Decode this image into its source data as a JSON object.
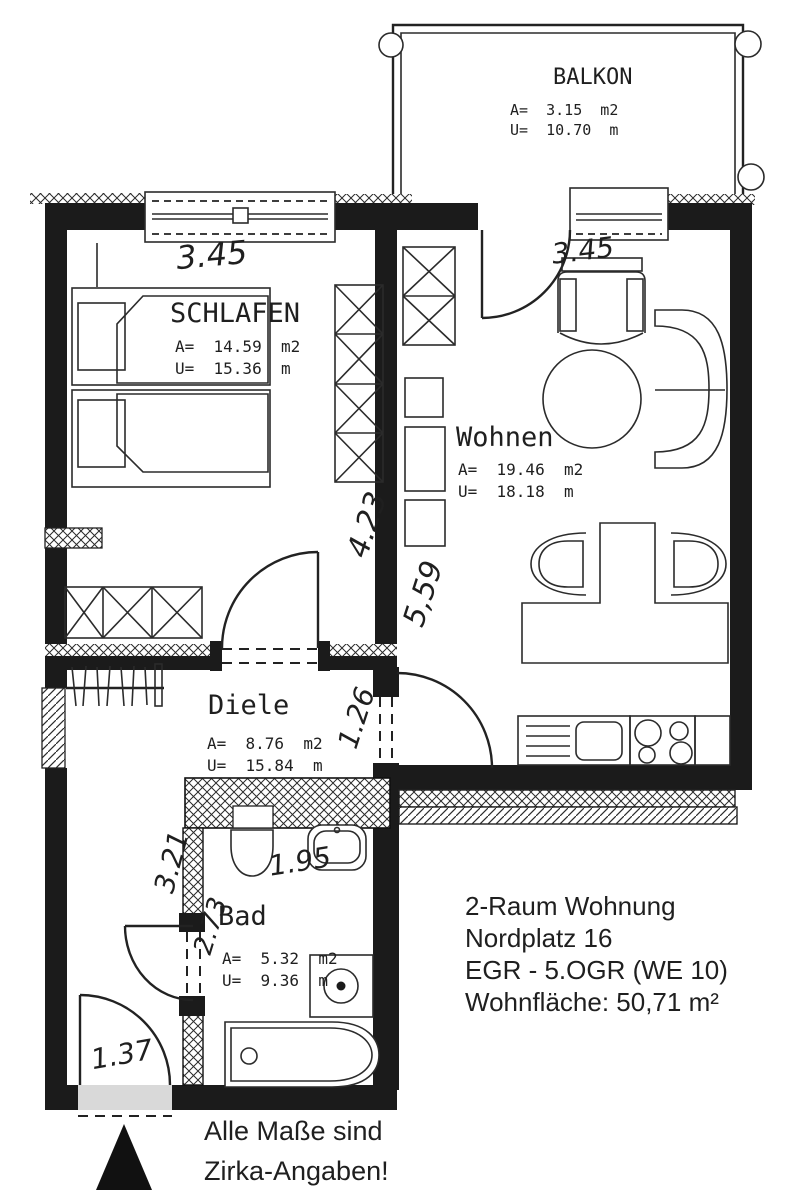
{
  "document": {
    "type": "apartment-floor-plan"
  },
  "balcony": {
    "name": "BALKON",
    "area": "A=  3.15  m2",
    "perimeter": "U=  10.70  m"
  },
  "rooms": {
    "schlafen": {
      "name": "SCHLAFEN",
      "area": "A=  14.59  m2",
      "perimeter": "U=  15.36  m"
    },
    "wohnen": {
      "name": "Wohnen",
      "area": "A=  19.46  m2",
      "perimeter": "U=  18.18  m"
    },
    "diele": {
      "name": "Diele",
      "area": "A=  8.76  m2",
      "perimeter": "U=  15.84  m"
    },
    "bad": {
      "name": "Bad",
      "area": "A=  5.32  m2",
      "perimeter": "U=  9.36  m"
    }
  },
  "dimensions": {
    "schlafen_width": "3.45",
    "wohnen_width": "3.45",
    "schlafen_depth": "4.23",
    "wohnen_depth": "5,59",
    "diele_opening": "1.26",
    "hall_left": "3.21",
    "bad_door": "2.73",
    "bad_width": "1.95",
    "entry_door": "1.37"
  },
  "info_block": {
    "line1": "2-Raum Wohnung",
    "line2": "Nordplatz 16",
    "line3": "EGR - 5.OGR (WE 10)",
    "line4": "Wohnfläche: 50,71 m²"
  },
  "disclaimer": {
    "line1": "Alle Maße sind",
    "line2": "Zirka-Angaben!"
  },
  "symbols": [
    "double-bed",
    "wardrobe",
    "coat-rack",
    "wc",
    "washbasin",
    "washing-machine",
    "bathtub",
    "armchair",
    "round-table",
    "sofa",
    "dining-table",
    "chair",
    "kitchen-sink",
    "stove",
    "door-swing",
    "window",
    "entrance-triangle"
  ],
  "colors": {
    "wall": "#1b1b1b",
    "line": "#2b2b2b",
    "paper": "#ffffff",
    "text": "#1f1f1f"
  }
}
